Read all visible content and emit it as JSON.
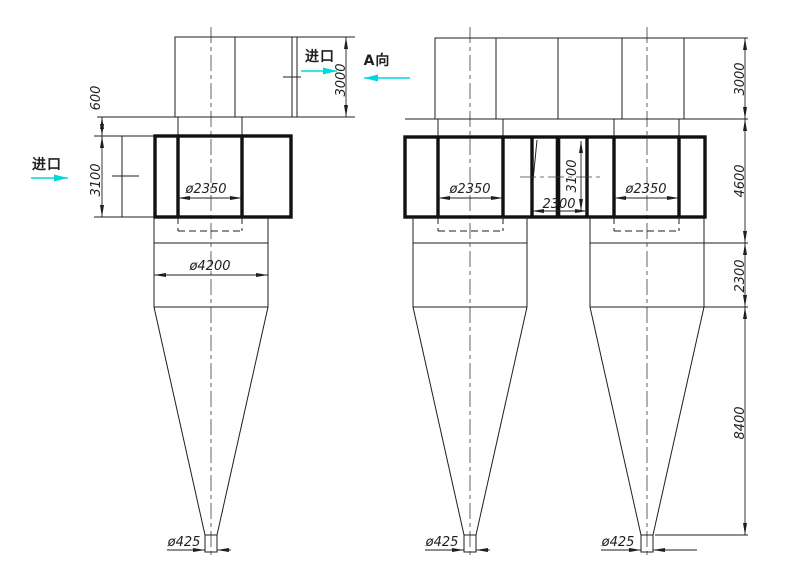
{
  "drawing": {
    "type": "cyclone-dust-collector-general-arrangement",
    "colors": {
      "background": "#ffffff",
      "line": "#1f1f1f",
      "accent_cyan": "#00d9d9"
    },
    "labels": {
      "inlet_top": "进口",
      "inlet_side": "进口",
      "view_a": "A向"
    },
    "left_view": {
      "dim_top_box_height": "3000",
      "dim_plate_gap": "600",
      "dim_body_height": "3100",
      "dim_outlet_dia": "ø2350",
      "dim_body_dia": "ø4200",
      "dim_discharge_dia": "ø425"
    },
    "right_view": {
      "dim_top_box_height": "3000",
      "dim_upper_height": "4600",
      "dim_mid_height": "2300",
      "dim_cone_height": "8400",
      "dim_outlet_dia_left": "ø2350",
      "dim_outlet_dia_right": "ø2350",
      "dim_center_gap": "2300",
      "dim_body_height": "3100",
      "dim_discharge_dia_left": "ø425",
      "dim_discharge_dia_right": "ø425"
    }
  }
}
